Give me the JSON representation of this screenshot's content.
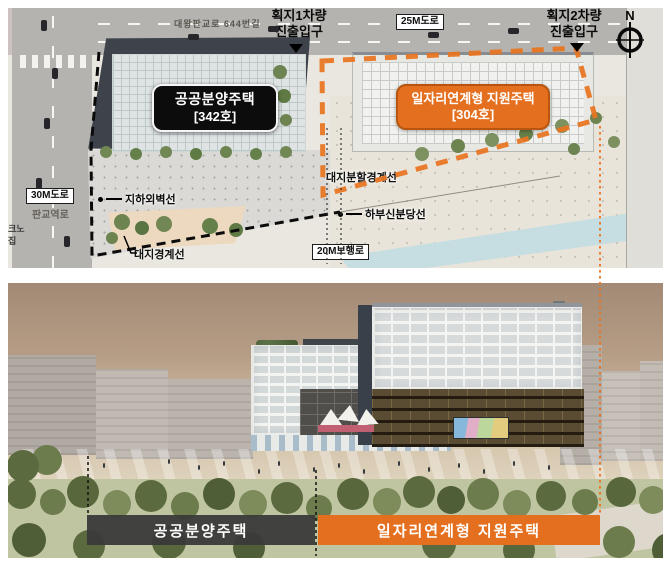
{
  "colors": {
    "accent_orange": "#e4701f",
    "label_black": "#0c0c0c",
    "bar_gray": "#3a3a3a"
  },
  "site_plan": {
    "roads": {
      "top_street": "대왕판교로 644번길",
      "road_25m": "25M도로",
      "road_30m": "30M도로",
      "road_30m_name": "판교역로",
      "walkway_20m": "20M보행로"
    },
    "entrance1_line1": "획지1차량",
    "entrance1_line2": "진출입구",
    "entrance2_line1": "획지2차량",
    "entrance2_line2": "진출입구",
    "compass_label": "N",
    "building_public": {
      "name": "공공분양주택",
      "units": "[342호]"
    },
    "building_support": {
      "name": "일자리연계형 지원주택",
      "units": "[304호]"
    },
    "annotations": {
      "underground_wall": "지하외벽선",
      "site_boundary": "대지경계선",
      "lot_division_boundary": "대지분할경계선",
      "subway_below": "하부신분당선"
    },
    "left_edge_text_line1": "크노",
    "left_edge_text_line2": "집"
  },
  "render_view": {
    "label_public": "공공분양주택",
    "label_support": "일자리연계형 지원주택"
  }
}
